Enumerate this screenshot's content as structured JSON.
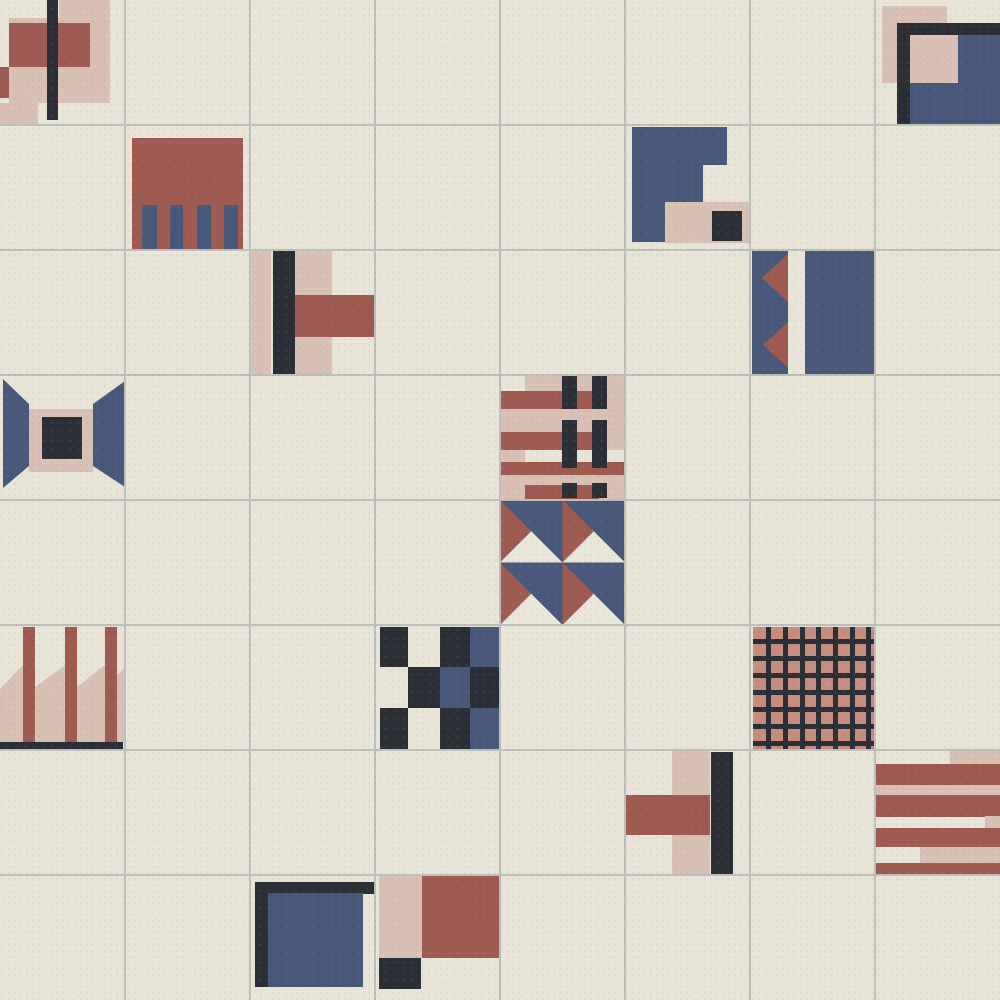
{
  "canvas": {
    "width": 1000,
    "height": 1000,
    "rows": 8,
    "cols": 8,
    "tile_size": 125
  },
  "colors": {
    "cream": "#e8e5d8",
    "grout": "#bcbfbc",
    "pink": "#d9c0b5",
    "red": "#9e5a50",
    "navy": "#48587a",
    "black": "#2b2f35",
    "salmon": "#c68d7e",
    "offwhite": "#eae7da"
  },
  "tiles": [
    {
      "row": 0,
      "col": 0,
      "name": "signal-flag-bars-tile",
      "shapes": [
        [
          "rect",
          9,
          18,
          101,
          85,
          "pink"
        ],
        [
          "rect",
          59,
          0,
          51,
          18,
          "pink"
        ],
        [
          "rect",
          9,
          23,
          81,
          44,
          "red"
        ],
        [
          "rect",
          0,
          67,
          9,
          31,
          "red"
        ],
        [
          "rect",
          0,
          103,
          38,
          22,
          "pink"
        ],
        [
          "rect",
          47,
          0,
          11,
          120,
          "black"
        ]
      ]
    },
    {
      "row": 0,
      "col": 7,
      "name": "corner-square-tile",
      "shapes": [
        [
          "rect",
          7,
          6,
          65,
          77,
          "pink"
        ],
        [
          "rect",
          22,
          23,
          103,
          102,
          "black"
        ],
        [
          "rect",
          35,
          35,
          90,
          90,
          "navy"
        ],
        [
          "rect",
          35,
          35,
          48,
          48,
          "pink"
        ]
      ]
    },
    {
      "row": 1,
      "col": 1,
      "name": "fringe-block-tile",
      "shapes": [
        [
          "rect",
          7,
          13,
          111,
          112,
          "red"
        ],
        [
          "rect",
          17,
          80,
          15,
          45,
          "navy"
        ],
        [
          "rect",
          45,
          80,
          13,
          45,
          "navy"
        ],
        [
          "rect",
          72,
          80,
          14,
          45,
          "navy"
        ],
        [
          "rect",
          99,
          80,
          14,
          45,
          "navy"
        ]
      ]
    },
    {
      "row": 1,
      "col": 5,
      "name": "steps-tile",
      "shapes": [
        [
          "poly",
          [
            [
              7,
              2
            ],
            [
              102,
              2
            ],
            [
              102,
              40
            ],
            [
              78,
              40
            ],
            [
              78,
              77
            ],
            [
              40,
              77
            ],
            [
              40,
              117
            ],
            [
              7,
              117
            ]
          ],
          "navy"
        ],
        [
          "rect",
          40,
          77,
          85,
          41,
          "pink"
        ],
        [
          "rect",
          87,
          86,
          30,
          30,
          "black"
        ]
      ]
    },
    {
      "row": 2,
      "col": 2,
      "name": "tee-right-tile",
      "shapes": [
        [
          "rect",
          0,
          0,
          21,
          125,
          "pink"
        ],
        [
          "rect",
          23,
          0,
          22,
          124,
          "black"
        ],
        [
          "rect",
          45,
          0,
          37,
          125,
          "pink"
        ],
        [
          "rect",
          45,
          45,
          80,
          42,
          "red"
        ]
      ]
    },
    {
      "row": 2,
      "col": 6,
      "name": "pennant-tile",
      "shapes": [
        [
          "rect",
          2,
          0,
          36,
          125,
          "navy"
        ],
        [
          "rect",
          55,
          0,
          70,
          125,
          "navy"
        ],
        [
          "poly",
          [
            [
              38,
              4
            ],
            [
              38,
              52
            ],
            [
              12,
              28
            ]
          ],
          "red"
        ],
        [
          "poly",
          [
            [
              38,
              72
            ],
            [
              38,
              118
            ],
            [
              13,
              95
            ]
          ],
          "red"
        ]
      ]
    },
    {
      "row": 3,
      "col": 0,
      "name": "tunnel-frame-tile",
      "shapes": [
        [
          "poly",
          [
            [
              3,
              4
            ],
            [
              29,
              29
            ],
            [
              29,
              91
            ],
            [
              3,
              113
            ]
          ],
          "navy"
        ],
        [
          "poly",
          [
            [
              125,
              6
            ],
            [
              93,
              29
            ],
            [
              93,
              91
            ],
            [
              125,
              112
            ]
          ],
          "navy"
        ],
        [
          "rect",
          29,
          34,
          64,
          63,
          "pink"
        ],
        [
          "rect",
          42,
          42,
          40,
          42,
          "black"
        ]
      ]
    },
    {
      "row": 3,
      "col": 4,
      "name": "plaid-weave-tile",
      "shapes": [
        [
          "rect",
          0,
          0,
          125,
          124,
          "pink"
        ],
        [
          "rect",
          0,
          0,
          25,
          16,
          "cream"
        ],
        [
          "rect",
          25,
          75,
          100,
          12,
          "cream"
        ],
        [
          "rect",
          0,
          16,
          99,
          18,
          "red"
        ],
        [
          "rect",
          0,
          57,
          99,
          18,
          "red"
        ],
        [
          "rect",
          0,
          87,
          125,
          13,
          "red"
        ],
        [
          "rect",
          25,
          110,
          74,
          14,
          "red"
        ],
        [
          "rect",
          62,
          0,
          15,
          34,
          "black"
        ],
        [
          "rect",
          92,
          0,
          15,
          34,
          "black"
        ],
        [
          "rect",
          62,
          45,
          15,
          48,
          "black"
        ],
        [
          "rect",
          92,
          45,
          15,
          48,
          "black"
        ],
        [
          "rect",
          62,
          108,
          15,
          15,
          "black"
        ],
        [
          "rect",
          92,
          108,
          15,
          15,
          "black"
        ]
      ]
    },
    {
      "row": 4,
      "col": 4,
      "name": "pinwheel-triangles-tile",
      "shapes": [
        [
          "rect",
          0,
          0,
          62.5,
          62.5,
          "navy"
        ],
        [
          "poly",
          [
            [
              0,
              0
            ],
            [
              31.25,
              31.25
            ],
            [
              0,
              62.5
            ]
          ],
          "red"
        ],
        [
          "poly",
          [
            [
              0,
              62.5
            ],
            [
              31.25,
              31.25
            ],
            [
              62.5,
              62.5
            ]
          ],
          "offwhite"
        ],
        [
          "rect",
          62.5,
          0,
          62.5,
          62.5,
          "navy"
        ],
        [
          "poly",
          [
            [
              62.5,
              0
            ],
            [
              93.75,
              31.25
            ],
            [
              62.5,
              62.5
            ]
          ],
          "red"
        ],
        [
          "poly",
          [
            [
              62.5,
              62.5
            ],
            [
              93.75,
              31.25
            ],
            [
              125,
              62.5
            ]
          ],
          "offwhite"
        ],
        [
          "rect",
          0,
          62.5,
          62.5,
          62.5,
          "navy"
        ],
        [
          "poly",
          [
            [
              0,
              62.5
            ],
            [
              31.25,
              93.75
            ],
            [
              0,
              125
            ]
          ],
          "red"
        ],
        [
          "poly",
          [
            [
              0,
              125
            ],
            [
              31.25,
              93.75
            ],
            [
              62.5,
              125
            ]
          ],
          "offwhite"
        ],
        [
          "rect",
          62.5,
          62.5,
          62.5,
          62.5,
          "navy"
        ],
        [
          "poly",
          [
            [
              62.5,
              62.5
            ],
            [
              93.75,
              93.75
            ],
            [
              62.5,
              125
            ]
          ],
          "red"
        ],
        [
          "poly",
          [
            [
              62.5,
              125
            ],
            [
              93.75,
              93.75
            ],
            [
              125,
              125
            ]
          ],
          "offwhite"
        ]
      ]
    },
    {
      "row": 5,
      "col": 0,
      "name": "ribbon-stripes-tile",
      "shapes": [
        [
          "poly",
          [
            [
              0,
              64
            ],
            [
              23,
              40
            ],
            [
              23,
              117
            ],
            [
              0,
              117
            ]
          ],
          "pink"
        ],
        [
          "poly",
          [
            [
              35,
              62
            ],
            [
              65,
              40
            ],
            [
              65,
              117
            ],
            [
              35,
              117
            ]
          ],
          "pink"
        ],
        [
          "poly",
          [
            [
              77,
              62
            ],
            [
              105,
              40
            ],
            [
              105,
              117
            ],
            [
              77,
              117
            ]
          ],
          "pink"
        ],
        [
          "poly",
          [
            [
              117,
              50
            ],
            [
              125,
              43
            ],
            [
              125,
              117
            ],
            [
              117,
              117
            ]
          ],
          "pink"
        ],
        [
          "rect",
          23,
          2,
          12,
          115,
          "red"
        ],
        [
          "rect",
          65,
          2,
          12,
          115,
          "red"
        ],
        [
          "rect",
          105,
          2,
          12,
          115,
          "red"
        ],
        [
          "rect",
          0,
          117,
          123,
          8,
          "black"
        ]
      ]
    },
    {
      "row": 5,
      "col": 3,
      "name": "checkerboard-tile",
      "shapes": [
        [
          "rect",
          5,
          2,
          28,
          40,
          "black"
        ],
        [
          "rect",
          65,
          2,
          30,
          40,
          "black"
        ],
        [
          "rect",
          95,
          2,
          30,
          40,
          "navy"
        ],
        [
          "rect",
          33,
          42,
          32,
          41,
          "black"
        ],
        [
          "rect",
          65,
          42,
          30,
          41,
          "navy"
        ],
        [
          "rect",
          95,
          42,
          30,
          41,
          "black"
        ],
        [
          "rect",
          5,
          83,
          28,
          42,
          "black"
        ],
        [
          "rect",
          65,
          83,
          30,
          42,
          "black"
        ],
        [
          "rect",
          95,
          83,
          30,
          42,
          "navy"
        ]
      ]
    },
    {
      "row": 5,
      "col": 6,
      "name": "waffle-grid-tile",
      "shapes": [
        [
          "rect",
          3,
          2,
          122,
          122,
          "salmon"
        ],
        [
          "rect",
          16,
          2,
          5,
          122,
          "black"
        ],
        [
          "rect",
          33,
          2,
          5,
          122,
          "black"
        ],
        [
          "rect",
          50,
          2,
          5,
          122,
          "black"
        ],
        [
          "rect",
          66,
          2,
          5,
          122,
          "black"
        ],
        [
          "rect",
          83,
          2,
          5,
          122,
          "black"
        ],
        [
          "rect",
          100,
          2,
          5,
          122,
          "black"
        ],
        [
          "rect",
          116,
          2,
          5,
          122,
          "black"
        ],
        [
          "rect",
          3,
          14,
          122,
          5,
          "black"
        ],
        [
          "rect",
          3,
          31,
          122,
          5,
          "black"
        ],
        [
          "rect",
          3,
          48,
          122,
          5,
          "black"
        ],
        [
          "rect",
          3,
          65,
          122,
          5,
          "black"
        ],
        [
          "rect",
          3,
          82,
          122,
          5,
          "black"
        ],
        [
          "rect",
          3,
          99,
          122,
          5,
          "black"
        ],
        [
          "rect",
          3,
          116,
          122,
          5,
          "black"
        ]
      ]
    },
    {
      "row": 6,
      "col": 5,
      "name": "tee-left-tile",
      "shapes": [
        [
          "rect",
          47,
          0,
          38,
          125,
          "pink"
        ],
        [
          "rect",
          0,
          45,
          85,
          40,
          "red"
        ],
        [
          "rect",
          86,
          2,
          22,
          123,
          "black"
        ]
      ]
    },
    {
      "row": 6,
      "col": 7,
      "name": "stripes-horizontal-tile",
      "shapes": [
        [
          "rect",
          75,
          0,
          50,
          14,
          "pink"
        ],
        [
          "rect",
          0,
          14,
          125,
          21,
          "red"
        ],
        [
          "rect",
          0,
          35,
          125,
          10,
          "pink"
        ],
        [
          "rect",
          0,
          45,
          125,
          22,
          "red"
        ],
        [
          "rect",
          110,
          66,
          15,
          12,
          "pink"
        ],
        [
          "rect",
          0,
          78,
          125,
          19,
          "red"
        ],
        [
          "rect",
          45,
          97,
          80,
          16,
          "pink"
        ],
        [
          "rect",
          0,
          113,
          125,
          12,
          "red"
        ]
      ]
    },
    {
      "row": 7,
      "col": 2,
      "name": "frame-corner-navy-tile",
      "shapes": [
        [
          "rect",
          5,
          7,
          120,
          12,
          "black"
        ],
        [
          "rect",
          5,
          7,
          13,
          105,
          "black"
        ],
        [
          "rect",
          18,
          18,
          95,
          94,
          "navy"
        ]
      ]
    },
    {
      "row": 7,
      "col": 3,
      "name": "quad-blocks-tile",
      "shapes": [
        [
          "rect",
          4,
          1,
          43,
          82,
          "pink"
        ],
        [
          "rect",
          47,
          1,
          78,
          82,
          "red"
        ],
        [
          "rect",
          4,
          83,
          42,
          31,
          "black"
        ]
      ]
    }
  ]
}
